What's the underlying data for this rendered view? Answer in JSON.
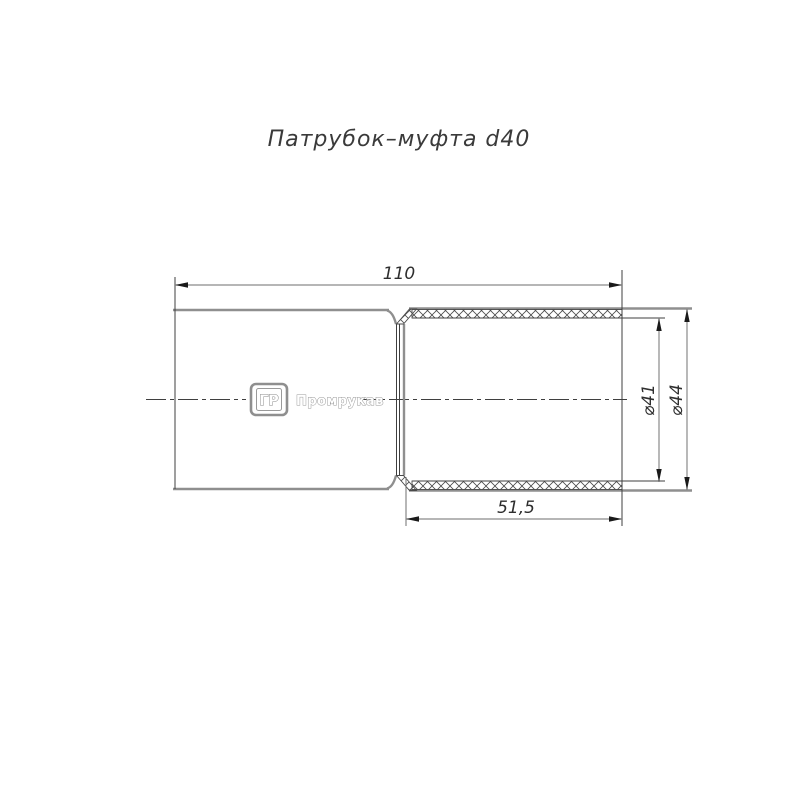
{
  "title": "Патрубок–муфта d40",
  "dimensions": {
    "total_length": "110",
    "socket_length": "51,5",
    "inner_diameter": "⌀41",
    "outer_diameter": "⌀44"
  },
  "logo": {
    "monogram": "ГР",
    "brand": "Промрукав"
  },
  "colors": {
    "background": "#ffffff",
    "body_outline": "#8f8f8f",
    "thin_line": "#3f3f3f",
    "dimension_line": "#8a8a8a",
    "arrowhead": "#1a1a1a",
    "text": "#2e2e2e"
  }
}
